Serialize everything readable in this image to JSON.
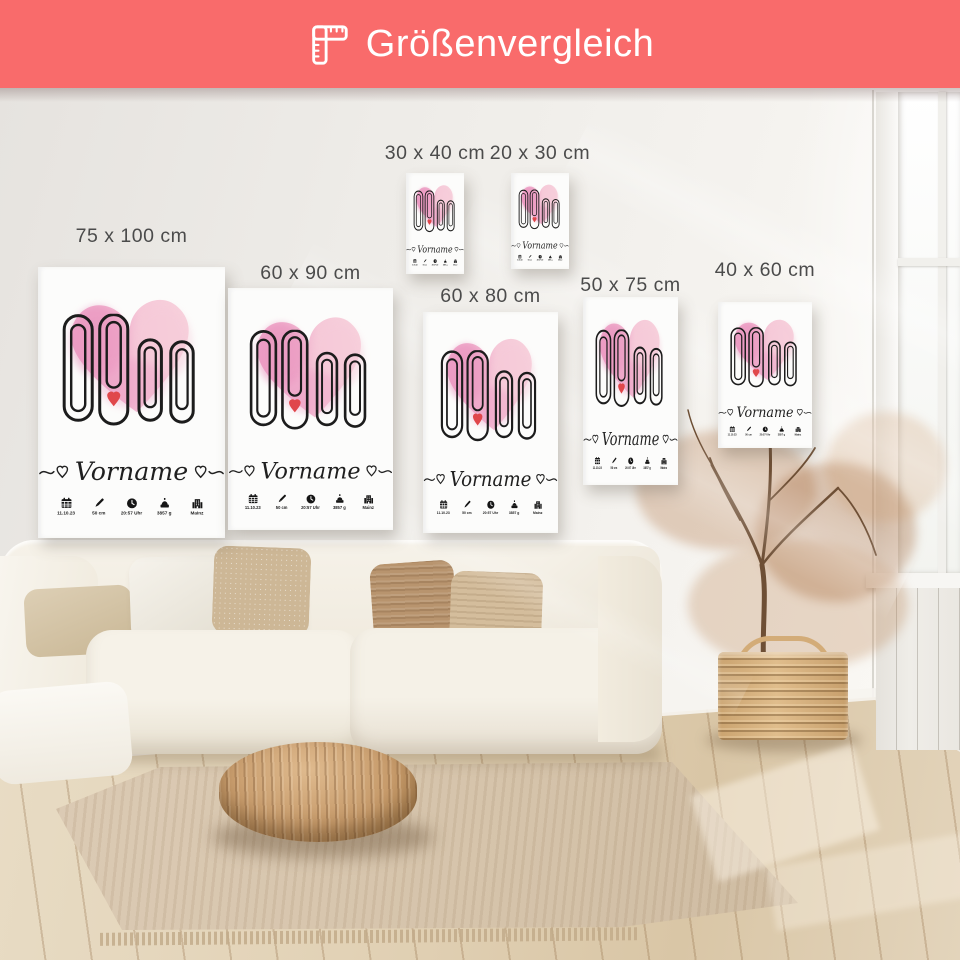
{
  "banner": {
    "title": "Größenvergleich"
  },
  "size_labels": [
    "75 x 100 cm",
    "60 x 90 cm",
    "30 x 40 cm",
    "20 x 30 cm",
    "60 x 80 cm",
    "50 x 75 cm",
    "40 x 60 cm"
  ],
  "poster": {
    "name": "Vorname",
    "stats": [
      {
        "icon": "calendar-icon",
        "value": "11.10.23"
      },
      {
        "icon": "pencil-icon",
        "value": "50 cm"
      },
      {
        "icon": "clock-icon",
        "value": "20:57 Uhr"
      },
      {
        "icon": "scale-icon",
        "value": "3857 g"
      },
      {
        "icon": "building-icon",
        "value": "Mainz"
      }
    ]
  },
  "colors": {
    "banner_bg": "#f96b6b",
    "heart_pink_dark": "#e78cba",
    "heart_pink_light": "#f7cdd9",
    "clip_outline": "#1c1c1c",
    "accent_heart_red": "#e0474b",
    "label_text": "#4b4b4b"
  }
}
